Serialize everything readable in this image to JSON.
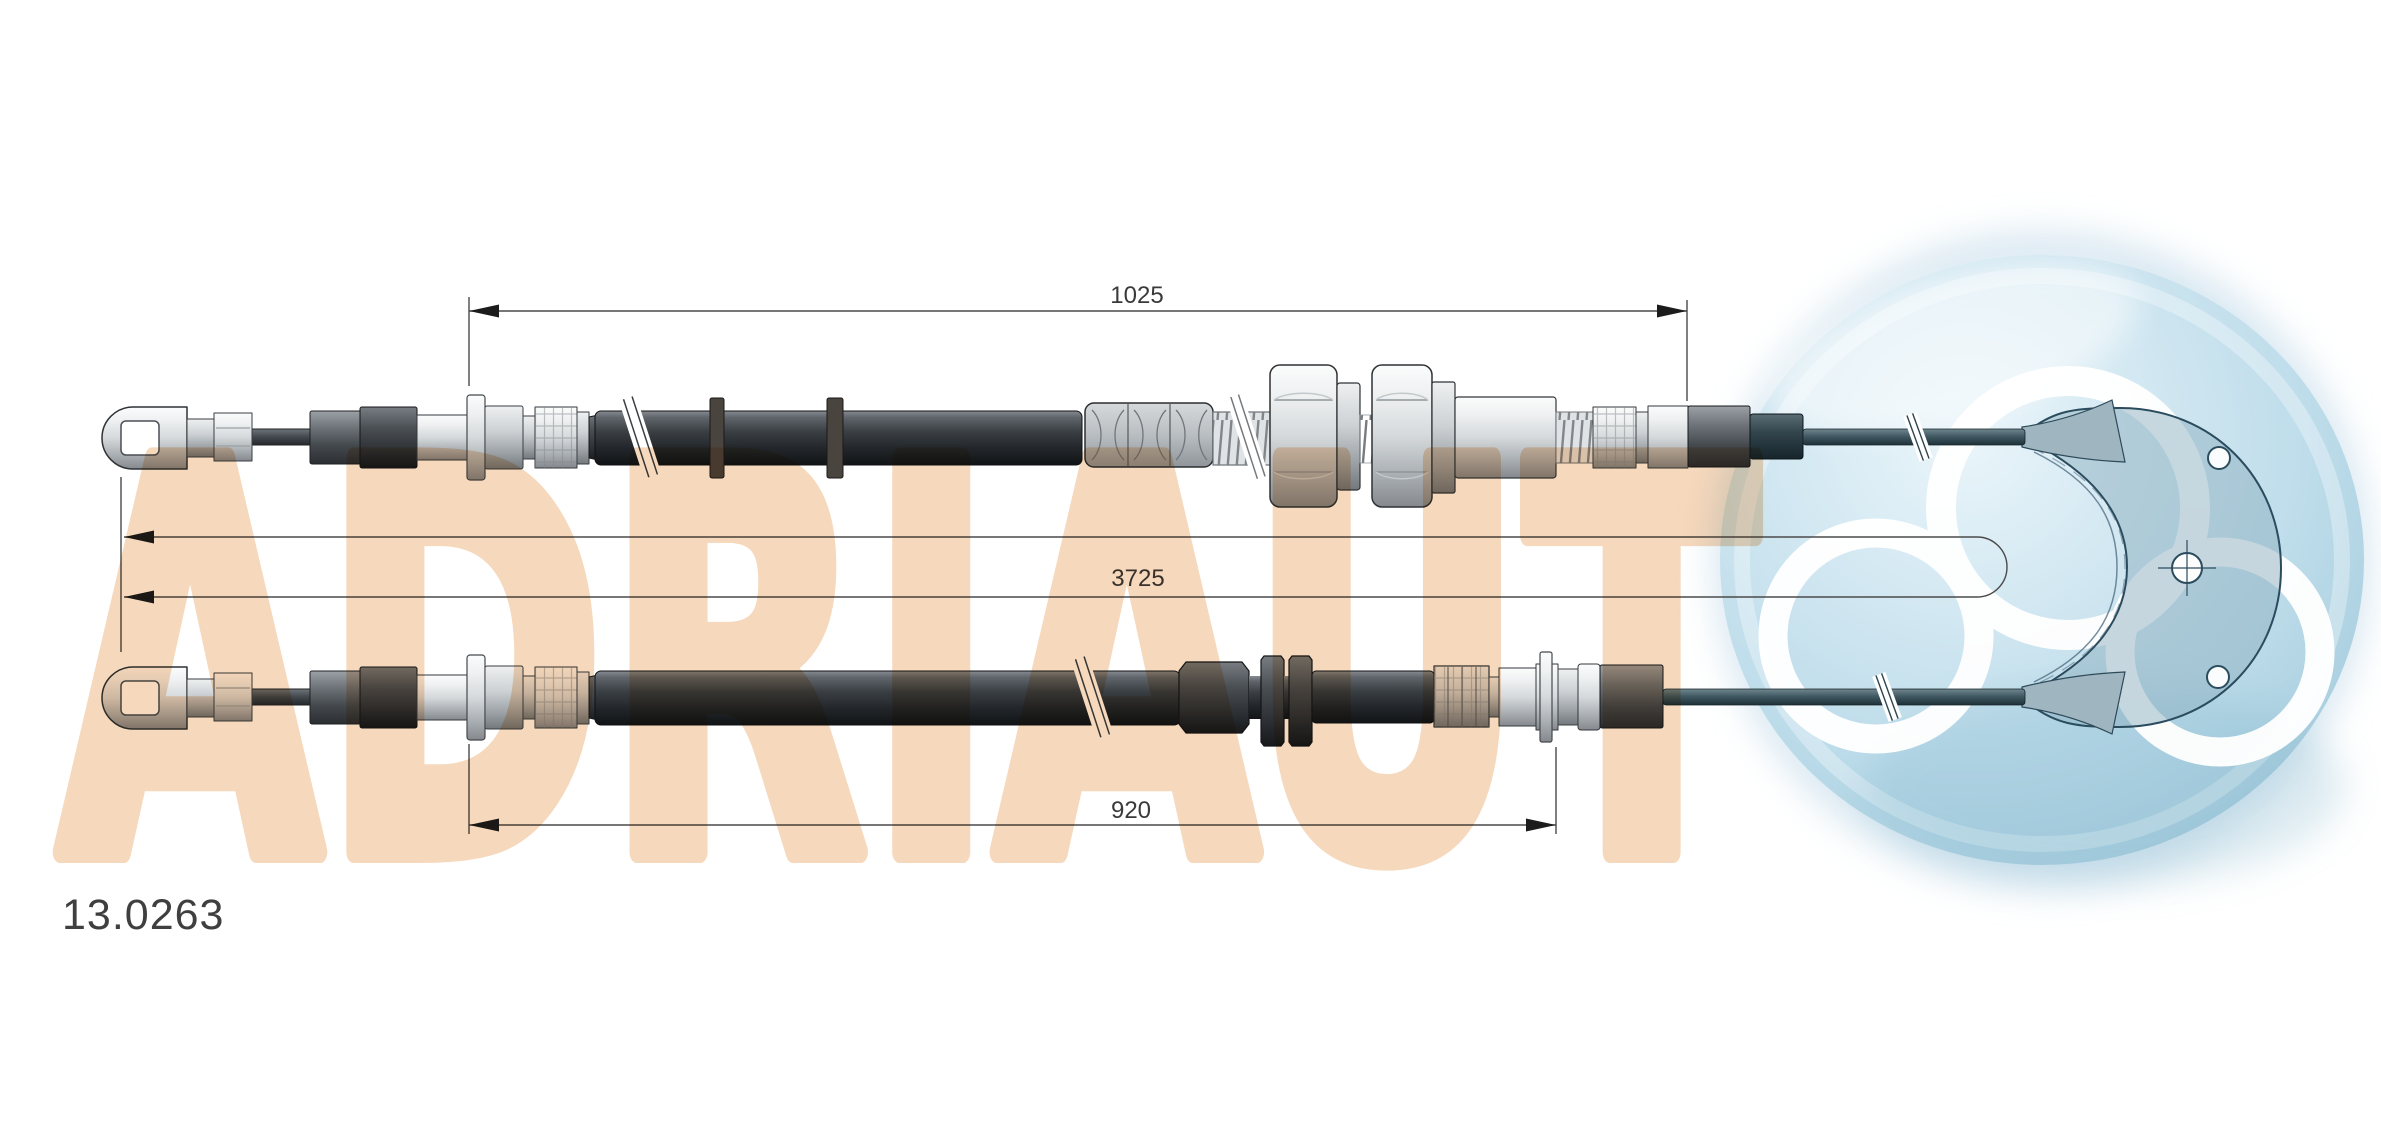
{
  "diagram": {
    "part_number": "13.0263",
    "watermark": "ADRIAUT",
    "dimensions": {
      "upper_sheath": "1025",
      "total_length": "3725",
      "lower_sheath": "920"
    },
    "colors": {
      "background": "#ffffff",
      "watermark_fill": "#f6d8bc",
      "logo_sphere": "#bddcea",
      "logo_rings": "#ffffff",
      "plate_outline": "#2b4c5e",
      "dimension_lines": "#4a4a4a",
      "cable_dark": "#22262a",
      "cable_teal": "#415a63",
      "metal_light": "#d5d9db"
    }
  }
}
